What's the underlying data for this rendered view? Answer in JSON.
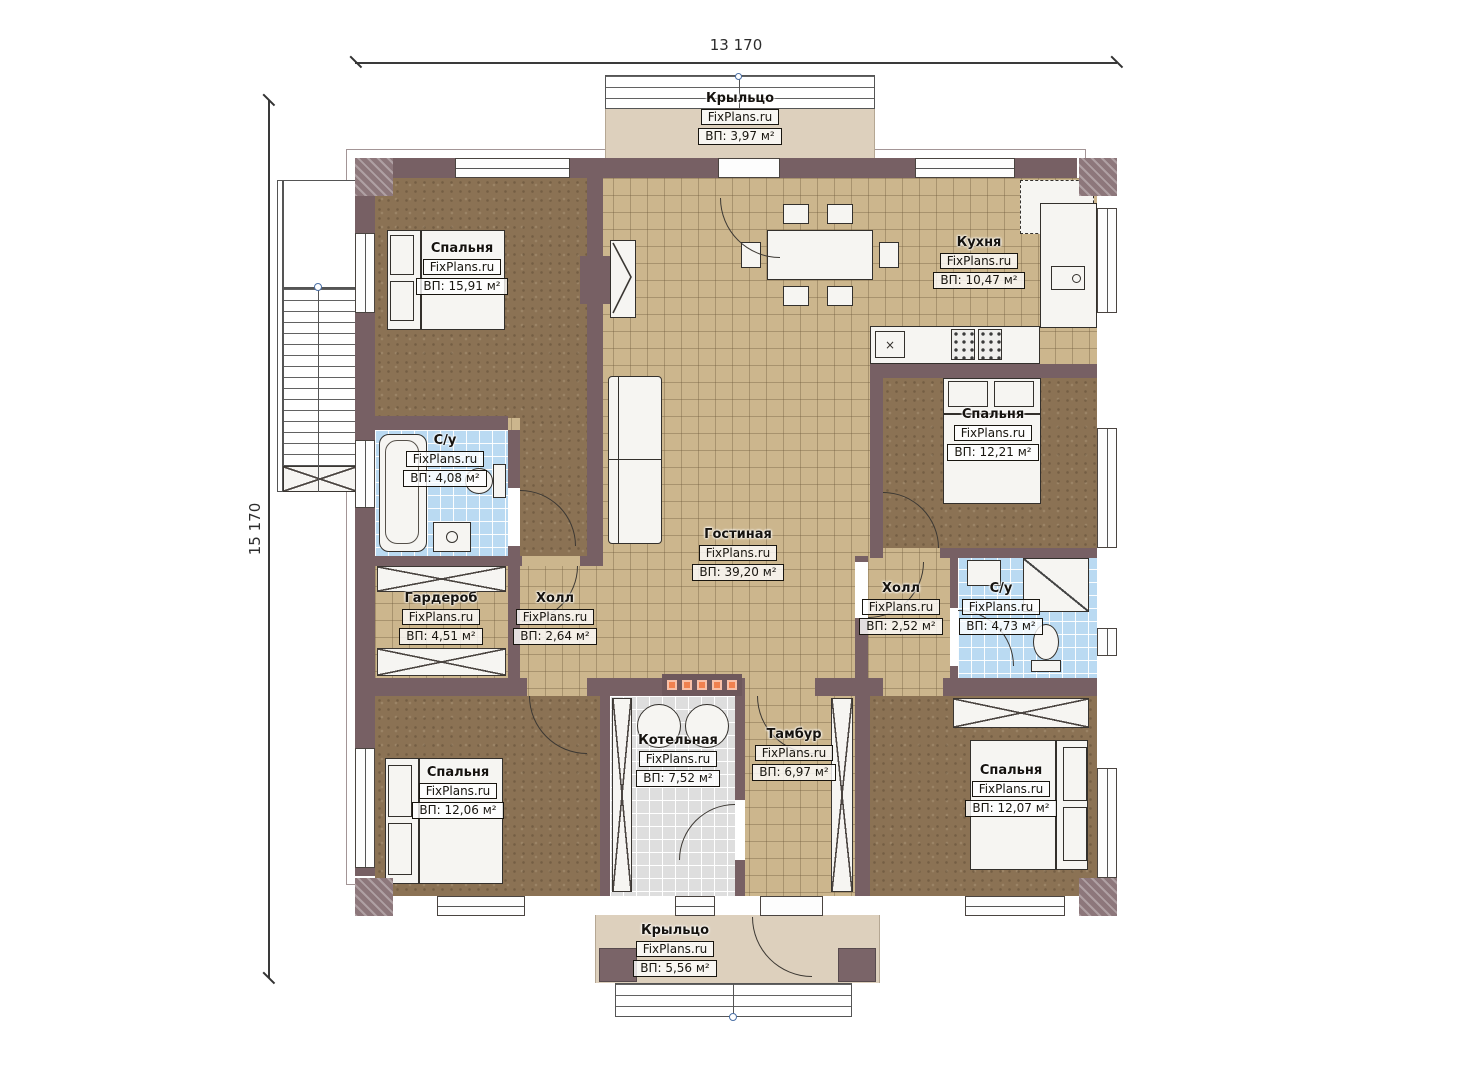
{
  "watermark": "FixPlans.ru",
  "dimensions": {
    "width": "13 170",
    "height": "15 170"
  },
  "rooms": {
    "porch_top": {
      "name": "Крыльцо",
      "area": "ВП: 3,97 м²"
    },
    "bedroom_tl": {
      "name": "Спальня",
      "area": "ВП: 15,91 м²"
    },
    "kitchen": {
      "name": "Кухня",
      "area": "ВП: 10,47 м²"
    },
    "living": {
      "name": "Гостиная",
      "area": "ВП: 39,20 м²"
    },
    "bath_left": {
      "name": "С/у",
      "area": "ВП: 4,08 м²"
    },
    "bedroom_right": {
      "name": "Спальня",
      "area": "ВП: 12,21 м²"
    },
    "wardrobe": {
      "name": "Гардероб",
      "area": "ВП: 4,51 м²"
    },
    "hall_left": {
      "name": "Холл",
      "area": "ВП: 2,64 м²"
    },
    "hall_right": {
      "name": "Холл",
      "area": "ВП: 2,52 м²"
    },
    "bath_right": {
      "name": "С/у",
      "area": "ВП: 4,73 м²"
    },
    "bedroom_bl": {
      "name": "Спальня",
      "area": "ВП: 12,06 м²"
    },
    "boiler": {
      "name": "Котельная",
      "area": "ВП: 7,52 м²"
    },
    "vestibule": {
      "name": "Тамбур",
      "area": "ВП: 6,97 м²"
    },
    "bedroom_br": {
      "name": "Спальня",
      "area": "ВП: 12,07 м²"
    },
    "porch_bottom": {
      "name": "Крыльцо",
      "area": "ВП: 5,56 м²"
    }
  },
  "colors": {
    "wall": "#776064",
    "tile": "#ccb68d",
    "wood_floor": "#8b7254",
    "bath_tile": "#badaf2",
    "boiler_tile": "#dedede",
    "porch": "#ddd0bd",
    "accent_orange": "#f0814f"
  }
}
